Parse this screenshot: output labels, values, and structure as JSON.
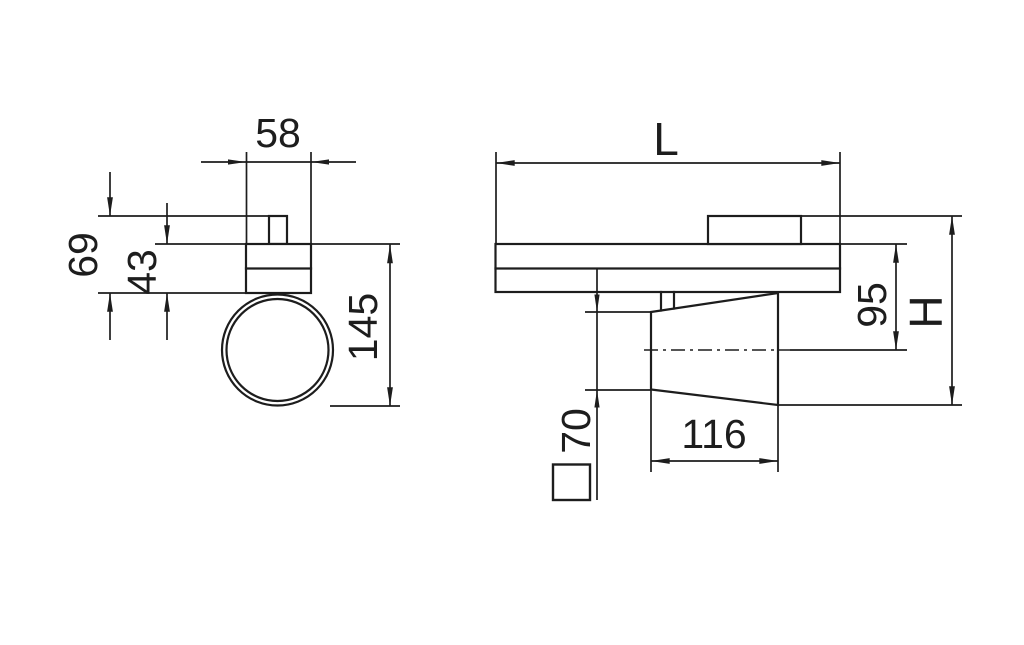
{
  "drawing": {
    "background_color": "#ffffff",
    "line_color": "#1d1d1d",
    "front_view": {
      "dim_adapter_width": "58",
      "dim_height_with_adapter": "69",
      "dim_body_height": "43",
      "dim_overall_height": "145"
    },
    "side_view": {
      "dim_length": "L",
      "dim_axis_height": "95",
      "dim_overall_height": "H",
      "dim_square_profile": "70",
      "dim_head_width": "116"
    }
  }
}
